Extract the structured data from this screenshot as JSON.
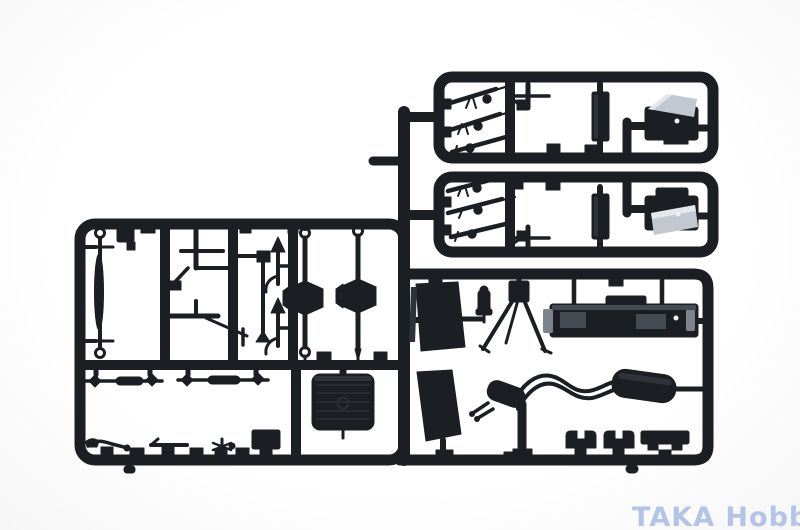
{
  "scene": {
    "description": "Black plastic model kit sprue (injection-molded parts tree) photographed on a white background",
    "background_color": "#ffffff"
  },
  "colors": {
    "sprue": "#1b1e23",
    "sheen": "#2e333a",
    "rib": "#2c3036",
    "gray_light": "#c3c8d0",
    "gray_lighter": "#e4e7ec",
    "gray_mid": "#7d838c",
    "detail_gray": "#454b53",
    "white_dot": "#eef0f3"
  },
  "watermark": {
    "text": "TAKA Hobby",
    "color": "#b3c4e8"
  },
  "sprue": {
    "material": "black styrene plastic",
    "part_groups": [
      "rifle-parts",
      "mg-mount-parts",
      "radio-box-parts",
      "cab-parts",
      "leaf-spring-part",
      "step-bracket-part",
      "lever-parts",
      "arrow-lever-parts",
      "axle-parts-with-differentials",
      "tie-rod-parts",
      "small-fitting-parts",
      "fuel-tank-part",
      "seat-parts",
      "cylinder-part",
      "tripod-part",
      "engine-part",
      "exhaust-pipe-with-muffler",
      "clip-parts",
      "rail-part"
    ]
  }
}
